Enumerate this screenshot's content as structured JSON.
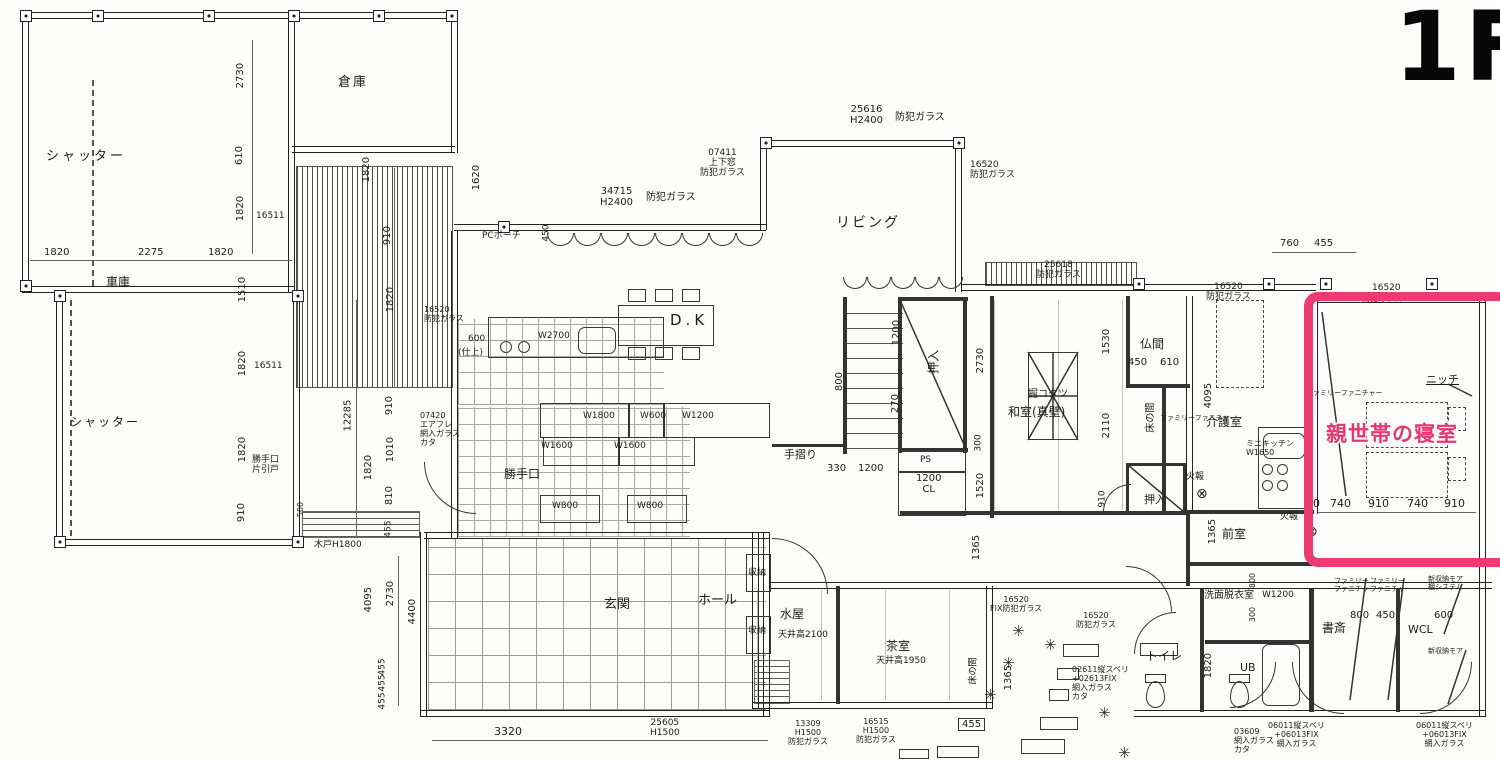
{
  "floor_tag": "1F",
  "highlight": {
    "label": "親世帯の寝室",
    "border_color": "#ee3a72",
    "text_color": "#e8356d"
  },
  "icons": {
    "plant": "✳",
    "fire_alarm": "⊗",
    "post": "⊡"
  },
  "labels": [
    {
      "t": "シャッター",
      "x": 46,
      "y": 150,
      "fs": 13,
      "ls": 3,
      "nm": "room-label-shutter-upper"
    },
    {
      "t": "倉庫",
      "x": 338,
      "y": 76,
      "fs": 13,
      "ls": 2,
      "nm": "room-label-storage"
    },
    {
      "t": "2730",
      "x": 228,
      "y": 70,
      "r": 1
    },
    {
      "t": "610",
      "x": 230,
      "y": 150,
      "r": 1
    },
    {
      "t": "1820",
      "x": 228,
      "y": 203,
      "r": 1
    },
    {
      "t": "16511",
      "x": 256,
      "y": 211,
      "fs": 9
    },
    {
      "t": "1820",
      "x": 44,
      "y": 247
    },
    {
      "t": "2275",
      "x": 138,
      "y": 247
    },
    {
      "t": "1820",
      "x": 208,
      "y": 247
    },
    {
      "t": "車庫",
      "x": 106,
      "y": 276,
      "fs": 12,
      "nm": "room-label-garage"
    },
    {
      "t": "1510",
      "x": 230,
      "y": 284,
      "r": 1
    },
    {
      "t": "1820",
      "x": 230,
      "y": 358,
      "r": 1
    },
    {
      "t": "16511",
      "x": 254,
      "y": 361,
      "fs": 9
    },
    {
      "t": "1820",
      "x": 230,
      "y": 444,
      "r": 1
    },
    {
      "t": "910",
      "x": 232,
      "y": 507,
      "r": 1
    },
    {
      "t": "シャッター",
      "x": 70,
      "y": 416,
      "fs": 12,
      "ls": 2,
      "nm": "room-label-shutter-lower"
    },
    {
      "t": "勝手口\n片引戸",
      "x": 252,
      "y": 455,
      "fs": 9,
      "nm": "label-side-door"
    },
    {
      "t": "500",
      "x": 294,
      "y": 505,
      "r": 1,
      "fs": 8
    },
    {
      "t": "木戸H1800",
      "x": 314,
      "y": 540,
      "fs": 9,
      "nm": "label-wood-gate"
    },
    {
      "t": "12285",
      "x": 332,
      "y": 410,
      "r": 1
    },
    {
      "t": "1820",
      "x": 356,
      "y": 462,
      "r": 1
    },
    {
      "t": "910",
      "x": 380,
      "y": 400,
      "r": 1
    },
    {
      "t": "1010",
      "x": 378,
      "y": 444,
      "r": 1
    },
    {
      "t": "810",
      "x": 380,
      "y": 490,
      "r": 1
    },
    {
      "t": "455",
      "x": 380,
      "y": 524,
      "r": 1,
      "fs": 9
    },
    {
      "t": "1820",
      "x": 354,
      "y": 164,
      "r": 1
    },
    {
      "t": "910",
      "x": 378,
      "y": 230,
      "r": 1
    },
    {
      "t": "1820",
      "x": 378,
      "y": 294,
      "r": 1
    },
    {
      "t": "16520\n防犯ガラス",
      "x": 424,
      "y": 306,
      "fs": 8,
      "nm": "window-label"
    },
    {
      "t": "1620",
      "x": 464,
      "y": 172,
      "r": 1
    },
    {
      "t": "PCポーチ",
      "x": 482,
      "y": 231,
      "fs": 9,
      "nm": "label-pc-porch"
    },
    {
      "t": "450",
      "x": 538,
      "y": 228,
      "r": 1,
      "fs": 9
    },
    {
      "t": "34715\nH2400",
      "x": 600,
      "y": 186,
      "fs": 10,
      "ctr": 1,
      "nm": "window-label"
    },
    {
      "t": "防犯ガラス",
      "x": 646,
      "y": 192,
      "fs": 10,
      "nm": "window-label"
    },
    {
      "t": "07411\n上下窓\n防犯ガラス",
      "x": 700,
      "y": 148,
      "fs": 9,
      "ctr": 1,
      "nm": "window-label"
    },
    {
      "t": "25616\nH2400",
      "x": 850,
      "y": 104,
      "fs": 10,
      "ctr": 1,
      "nm": "window-label"
    },
    {
      "t": "防犯ガラス",
      "x": 895,
      "y": 112,
      "fs": 10,
      "nm": "window-label"
    },
    {
      "t": "リビング",
      "x": 836,
      "y": 216,
      "fs": 14,
      "ls": 2,
      "nm": "room-label-living"
    },
    {
      "t": "16520\n防犯ガラス",
      "x": 970,
      "y": 160,
      "fs": 9,
      "nm": "window-label"
    },
    {
      "t": "D.K",
      "x": 670,
      "y": 312,
      "fs": 15,
      "ls": 4,
      "nm": "room-label-dk"
    },
    {
      "t": "W2700",
      "x": 538,
      "y": 331,
      "fs": 9
    },
    {
      "t": "600",
      "x": 468,
      "y": 334,
      "fs": 9
    },
    {
      "t": "(仕上)",
      "x": 458,
      "y": 348,
      "fs": 9
    },
    {
      "t": "W1800",
      "x": 583,
      "y": 411,
      "fs": 9
    },
    {
      "t": "W600",
      "x": 640,
      "y": 411,
      "fs": 9
    },
    {
      "t": "W1200",
      "x": 682,
      "y": 411,
      "fs": 9
    },
    {
      "t": "W1600",
      "x": 541,
      "y": 441,
      "fs": 9
    },
    {
      "t": "W1600",
      "x": 614,
      "y": 441,
      "fs": 9
    },
    {
      "t": "W800",
      "x": 552,
      "y": 501,
      "fs": 9
    },
    {
      "t": "W800",
      "x": 637,
      "y": 501,
      "fs": 9
    },
    {
      "t": "勝手口",
      "x": 504,
      "y": 468,
      "fs": 12,
      "nm": "room-label-kitchen-door"
    },
    {
      "t": "07420\nエアフレ\n網入ガラス\nカタ",
      "x": 420,
      "y": 412,
      "fs": 8,
      "nm": "window-label"
    },
    {
      "t": "手摺り",
      "x": 784,
      "y": 449,
      "fs": 11,
      "nm": "label-handrail"
    },
    {
      "t": "25618\n防犯ガラス",
      "x": 1036,
      "y": 260,
      "fs": 9,
      "ctr": 1,
      "nm": "window-label"
    },
    {
      "t": "1200",
      "x": 884,
      "y": 327,
      "r": 1
    },
    {
      "t": "270",
      "x": 886,
      "y": 398,
      "r": 1
    },
    {
      "t": "800",
      "x": 830,
      "y": 376,
      "r": 1
    },
    {
      "t": "押入",
      "x": 922,
      "y": 355,
      "r": 1,
      "fs": 12,
      "nm": "room-label-closet-1"
    },
    {
      "t": "2730",
      "x": 968,
      "y": 355,
      "r": 1
    },
    {
      "t": "300",
      "x": 970,
      "y": 438,
      "r": 1,
      "fs": 9
    },
    {
      "t": "1520",
      "x": 968,
      "y": 480,
      "r": 1
    },
    {
      "t": "PS",
      "x": 920,
      "y": 455,
      "fs": 9,
      "nm": "label-ps"
    },
    {
      "t": "1200\nCL",
      "x": 916,
      "y": 473,
      "fs": 10,
      "ctr": 1,
      "nm": "label-cl"
    },
    {
      "t": "330",
      "x": 827,
      "y": 463,
      "fs": 10
    },
    {
      "t": "1200",
      "x": 858,
      "y": 463,
      "fs": 10
    },
    {
      "t": "掘コタツ",
      "x": 1028,
      "y": 389,
      "fs": 10,
      "nm": "label-kotatsu"
    },
    {
      "t": "和室(真壁)",
      "x": 1008,
      "y": 406,
      "fs": 12,
      "nm": "room-label-washitsu"
    },
    {
      "t": "1530",
      "x": 1094,
      "y": 336,
      "r": 1
    },
    {
      "t": "2110",
      "x": 1094,
      "y": 420,
      "r": 1
    },
    {
      "t": "仏間",
      "x": 1140,
      "y": 338,
      "fs": 12,
      "nm": "room-label-butsuma"
    },
    {
      "t": "450",
      "x": 1128,
      "y": 357,
      "fs": 10
    },
    {
      "t": "610",
      "x": 1160,
      "y": 357,
      "fs": 10
    },
    {
      "t": "床の間",
      "x": 1136,
      "y": 412,
      "r": 1,
      "fs": 10,
      "nm": "room-label-tokonoma-1"
    },
    {
      "t": "ファミリーファニチャー",
      "x": 1160,
      "y": 415,
      "fs": 7,
      "nm": "label-family-furniture"
    },
    {
      "t": "4095",
      "x": 1196,
      "y": 390,
      "r": 1
    },
    {
      "t": "介護室",
      "x": 1206,
      "y": 416,
      "fs": 12,
      "nm": "room-label-care-room"
    },
    {
      "t": "910",
      "x": 1094,
      "y": 494,
      "r": 1,
      "fs": 9
    },
    {
      "t": "押入",
      "x": 1144,
      "y": 494,
      "fs": 11,
      "nm": "room-label-closet-2"
    },
    {
      "t": "火報",
      "x": 1186,
      "y": 472,
      "fs": 9,
      "nm": "label-fire-alarm"
    },
    {
      "t": "ミニキッチン\nW1650",
      "x": 1246,
      "y": 440,
      "fs": 8,
      "nm": "label-mini-kitchen"
    },
    {
      "t": "1365",
      "x": 1200,
      "y": 526,
      "r": 1
    },
    {
      "t": "前室",
      "x": 1222,
      "y": 528,
      "fs": 12,
      "nm": "room-label-anteroom"
    },
    {
      "t": "火報",
      "x": 1280,
      "y": 512,
      "fs": 9,
      "nm": "label-fire-alarm"
    },
    {
      "t": "ファミリーファニチャー",
      "x": 1306,
      "y": 390,
      "fs": 7,
      "nm": "label-family-furniture"
    },
    {
      "t": "ニッチ",
      "x": 1426,
      "y": 374,
      "fs": 11,
      "ul": 1,
      "nm": "label-niche"
    },
    {
      "t": "16520",
      "x": 1372,
      "y": 283,
      "fs": 9,
      "nm": "window-label"
    },
    {
      "t": "防犯ガラス",
      "x": 1362,
      "y": 295,
      "fs": 8,
      "nm": "window-label"
    },
    {
      "t": "16520\n防犯ガラス",
      "x": 1206,
      "y": 282,
      "fs": 9,
      "ctr": 1,
      "nm": "window-label"
    },
    {
      "t": "760",
      "x": 1280,
      "y": 238,
      "fs": 10
    },
    {
      "t": "455",
      "x": 1314,
      "y": 238,
      "fs": 10
    },
    {
      "t": "0",
      "x": 1313,
      "y": 498,
      "fs": 11
    },
    {
      "t": "740",
      "x": 1330,
      "y": 498,
      "fs": 11
    },
    {
      "t": "910",
      "x": 1368,
      "y": 498,
      "fs": 11
    },
    {
      "t": "740",
      "x": 1407,
      "y": 498,
      "fs": 11
    },
    {
      "t": "910",
      "x": 1444,
      "y": 498,
      "fs": 11
    },
    {
      "t": "玄関",
      "x": 604,
      "y": 598,
      "fs": 13,
      "nm": "room-label-entrance"
    },
    {
      "t": "ホール",
      "x": 698,
      "y": 594,
      "fs": 13,
      "nm": "room-label-hall"
    },
    {
      "t": "収納",
      "x": 748,
      "y": 568,
      "fs": 9,
      "nm": "label-storage"
    },
    {
      "t": "収納",
      "x": 748,
      "y": 626,
      "fs": 9,
      "nm": "label-storage"
    },
    {
      "t": "水屋",
      "x": 780,
      "y": 608,
      "fs": 12,
      "nm": "room-label-mizuya"
    },
    {
      "t": "天井高2100",
      "x": 778,
      "y": 630,
      "fs": 9,
      "nm": "label-ceiling-height"
    },
    {
      "t": "茶室",
      "x": 886,
      "y": 640,
      "fs": 12,
      "nm": "room-label-tea-room"
    },
    {
      "t": "天井高1950",
      "x": 876,
      "y": 656,
      "fs": 9,
      "nm": "label-ceiling-height"
    },
    {
      "t": "床の間",
      "x": 960,
      "y": 666,
      "r": 1,
      "fs": 9,
      "nm": "room-label-tokonoma-2"
    },
    {
      "t": "1365",
      "x": 964,
      "y": 542,
      "r": 1
    },
    {
      "t": "1365",
      "x": 996,
      "y": 672,
      "r": 1
    },
    {
      "t": "455",
      "x": 958,
      "y": 718,
      "fs": 10,
      "bx": 1
    },
    {
      "t": "4095",
      "x": 356,
      "y": 594,
      "r": 1
    },
    {
      "t": "2730",
      "x": 378,
      "y": 588,
      "r": 1
    },
    {
      "t": "4400",
      "x": 400,
      "y": 606,
      "r": 1
    },
    {
      "t": "455",
      "x": 374,
      "y": 662,
      "r": 1,
      "fs": 9
    },
    {
      "t": "455",
      "x": 374,
      "y": 678,
      "r": 1,
      "fs": 9
    },
    {
      "t": "455",
      "x": 374,
      "y": 696,
      "r": 1,
      "fs": 9
    },
    {
      "t": "3320",
      "x": 494,
      "y": 726,
      "fs": 11
    },
    {
      "t": "25605\nH1500",
      "x": 650,
      "y": 718,
      "fs": 9,
      "ctr": 1,
      "nm": "window-label"
    },
    {
      "t": "13309\nH1500\n防犯ガラス",
      "x": 788,
      "y": 720,
      "fs": 8,
      "ctr": 1,
      "nm": "window-label"
    },
    {
      "t": "16515\nH1500\n防犯ガラス",
      "x": 856,
      "y": 718,
      "fs": 8,
      "ctr": 1,
      "nm": "window-label"
    },
    {
      "t": "16520\nFIX防犯ガラス",
      "x": 990,
      "y": 596,
      "fs": 8,
      "ctr": 1,
      "nm": "window-label"
    },
    {
      "t": "16520\n防犯ガラス",
      "x": 1076,
      "y": 612,
      "fs": 8,
      "ctr": 1,
      "nm": "window-label"
    },
    {
      "t": "02611縦スベリ\n+02613FIX\n網入ガラス\nカタ",
      "x": 1072,
      "y": 666,
      "fs": 8,
      "nm": "window-label"
    },
    {
      "t": "トイレ",
      "x": 1146,
      "y": 650,
      "fs": 12,
      "nm": "room-label-toilet"
    },
    {
      "t": "1820",
      "x": 1196,
      "y": 660,
      "r": 1
    },
    {
      "t": "UB",
      "x": 1240,
      "y": 662,
      "fs": 11,
      "nm": "room-label-ub"
    },
    {
      "t": "洗面脱衣室",
      "x": 1204,
      "y": 590,
      "fs": 10,
      "nm": "room-label-washroom"
    },
    {
      "t": "W1200",
      "x": 1262,
      "y": 590,
      "fs": 9
    },
    {
      "t": "800",
      "x": 1246,
      "y": 576,
      "r": 1,
      "fs": 8
    },
    {
      "t": "300",
      "x": 1246,
      "y": 610,
      "r": 1,
      "fs": 8
    },
    {
      "t": "書斎",
      "x": 1322,
      "y": 622,
      "fs": 12,
      "nm": "room-label-study"
    },
    {
      "t": "WCL",
      "x": 1408,
      "y": 624,
      "fs": 11,
      "nm": "room-label-wcl"
    },
    {
      "t": "ファミリー\nファニチャー",
      "x": 1334,
      "y": 578,
      "fs": 7,
      "nm": "label-family-furniture"
    },
    {
      "t": "ファミリー\nファニチャー",
      "x": 1370,
      "y": 578,
      "fs": 7,
      "nm": "label-family-furniture"
    },
    {
      "t": "800",
      "x": 1350,
      "y": 610,
      "fs": 10
    },
    {
      "t": "450",
      "x": 1376,
      "y": 610,
      "fs": 10
    },
    {
      "t": "新収納モア\n棚システム",
      "x": 1428,
      "y": 576,
      "fs": 7,
      "nm": "label-storage-system"
    },
    {
      "t": "600",
      "x": 1434,
      "y": 610,
      "fs": 10
    },
    {
      "t": "新収納モア",
      "x": 1428,
      "y": 648,
      "fs": 7,
      "nm": "label-storage-system"
    },
    {
      "t": "03609\n網入ガラス\nカタ",
      "x": 1234,
      "y": 728,
      "fs": 8,
      "nm": "window-label"
    },
    {
      "t": "06011縦スベリ\n+06013FIX\n網入ガラス",
      "x": 1268,
      "y": 722,
      "fs": 8,
      "ctr": 1,
      "nm": "window-label"
    },
    {
      "t": "06011縦スベリ\n+06013FIX\n網入ガラス",
      "x": 1416,
      "y": 722,
      "fs": 8,
      "ctr": 1,
      "nm": "window-label"
    }
  ],
  "symbols": {
    "plants": [
      [
        1012,
        622
      ],
      [
        1044,
        636
      ],
      [
        1002,
        654
      ],
      [
        1098,
        704
      ],
      [
        1118,
        744
      ],
      [
        984,
        686
      ]
    ],
    "fire_alarms": [
      [
        1196,
        486
      ],
      [
        1306,
        524
      ]
    ],
    "posts": [
      [
        92,
        10
      ],
      [
        203,
        10
      ],
      [
        288,
        10
      ],
      [
        373,
        10
      ],
      [
        446,
        10
      ],
      [
        20,
        10
      ],
      [
        20,
        280
      ],
      [
        54,
        290
      ],
      [
        292,
        290
      ],
      [
        54,
        536
      ],
      [
        292,
        536
      ],
      [
        498,
        221
      ],
      [
        760,
        137
      ],
      [
        953,
        137
      ],
      [
        1133,
        278
      ],
      [
        1263,
        278
      ],
      [
        1320,
        278
      ],
      [
        1426,
        278
      ]
    ]
  }
}
